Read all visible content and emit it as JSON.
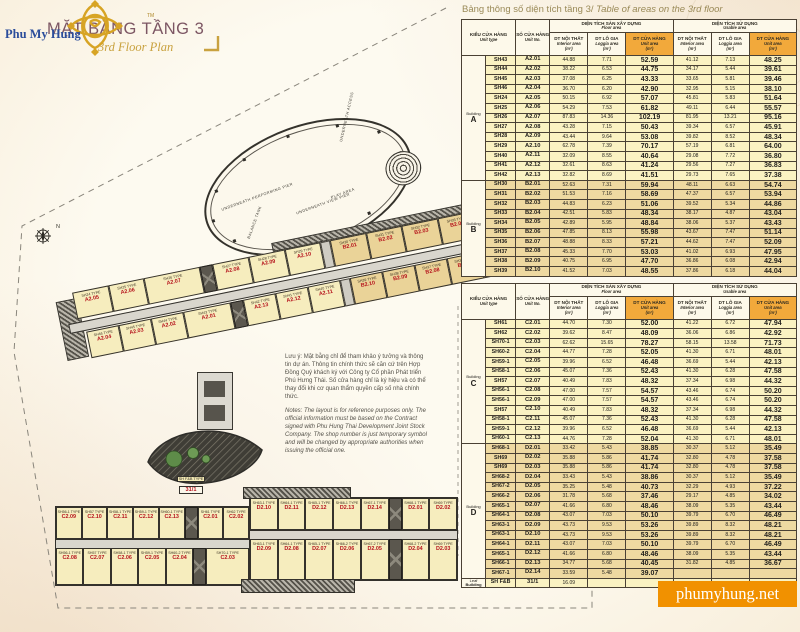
{
  "header": {
    "brand": "Phu My Hung",
    "brand_tm": "TM",
    "title_vi": "MẶT BẰNG TẦNG 3",
    "title_en": "3rd Floor Plan"
  },
  "plan": {
    "compass_label": "N",
    "ellipse_labels": {
      "performing": "UNDERNEATH PERFORMING PIER",
      "access": "UNDERNEATH ACCESS",
      "view_pier": "UNDERNEATH VIEW PIER",
      "play_area": "PLAY AREA",
      "balance_tank": "BALANCE TANK"
    },
    "notes_vi": "Lưu ý: Mặt bằng chỉ để tham khảo ý tưởng và thông tin dự án. Thông tin chính thức sẽ căn cứ trên Hợp Đồng Quý khách ký với Công ty Cổ phần Phát triển Phú Hưng Thái. Số cửa hàng chỉ là ký hiệu và có thể thay đổi khi cơ quan thẩm quyền cấp số nhà chính thức.",
    "notes_en": "Notes: The layout is for reference purposes only. The official information must be based on the Contract signed with Phu Hung Thai Development Joint Stock Company. The shop number is just temporary symbol and will be changed by appropriate authorities when issuing the official one.",
    "leaf": {
      "type": "SH F&B TYPE",
      "no": "31/1"
    },
    "strips": {
      "a_top": [
        {
          "t": "SH24 TYPE",
          "n": "A2.05"
        },
        {
          "t": "SH25 TYPE",
          "n": "A2.06"
        },
        {
          "t": "SH26 TYPE",
          "n": "A2.07",
          "w": 1.6
        },
        {
          "core": true
        },
        {
          "t": "SH27 TYPE",
          "n": "A2.08"
        },
        {
          "t": "SH28 TYPE",
          "n": "A2.09"
        },
        {
          "t": "SH29 TYPE",
          "n": "A2.10"
        },
        {
          "gap": true
        },
        {
          "t": "SH30 TYPE",
          "n": "B2.01",
          "b": 1
        },
        {
          "t": "SH31 TYPE",
          "n": "B2.02",
          "b": 1
        },
        {
          "t": "SH32 TYPE",
          "n": "B2.03",
          "b": 1
        },
        {
          "t": "SH33 TYPE",
          "n": "B2.04",
          "b": 1
        },
        {
          "t": "SH34 TYPE",
          "n": "B2.05",
          "b": 1
        }
      ],
      "a_bottom": [
        {
          "t": "SH46 TYPE",
          "n": "A2.04"
        },
        {
          "t": "SH45 TYPE",
          "n": "A2.03"
        },
        {
          "t": "SH44 TYPE",
          "n": "A2.02"
        },
        {
          "t": "SH43 TYPE",
          "n": "A2.01",
          "w": 1.5
        },
        {
          "core": true
        },
        {
          "t": "SH42 TYPE",
          "n": "A2.13"
        },
        {
          "t": "SH41 TYPE",
          "n": "A2.12"
        },
        {
          "t": "SH40 TYPE",
          "n": "A2.11"
        },
        {
          "gap": true
        },
        {
          "t": "SH39 TYPE",
          "n": "B2.10",
          "b": 1
        },
        {
          "t": "SH38 TYPE",
          "n": "B2.09",
          "b": 1
        },
        {
          "t": "SH37 TYPE",
          "n": "B2.08",
          "b": 1
        },
        {
          "t": "SH36 TYPE",
          "n": "B2.07",
          "b": 1
        },
        {
          "t": "SH35 TYPE",
          "n": "B2.06",
          "b": 1
        }
      ],
      "c_top": [
        {
          "t": "SH56-1 TYPE",
          "n": "C2.09"
        },
        {
          "t": "SH57 TYPE",
          "n": "C2.10"
        },
        {
          "t": "SH58-1 TYPE",
          "n": "C2.11"
        },
        {
          "t": "SH59-1 TYPE",
          "n": "C2.12"
        },
        {
          "t": "SH60-1 TYPE",
          "n": "C2.13"
        },
        {
          "core": true
        },
        {
          "t": "SH61 TYPE",
          "n": "C2.01"
        },
        {
          "t": "SH62 TYPE",
          "n": "C2.02"
        }
      ],
      "c_bottom": [
        {
          "t": "SH56-1 TYPE",
          "n": "C2.08"
        },
        {
          "t": "SH57 TYPE",
          "n": "C2.07"
        },
        {
          "t": "SH58-1 TYPE",
          "n": "C2.06"
        },
        {
          "t": "SH59-1 TYPE",
          "n": "C2.05"
        },
        {
          "t": "SH60-2 TYPE",
          "n": "C2.04"
        },
        {
          "core": true
        },
        {
          "t": "SH70-1 TYPE",
          "n": "C2.03",
          "w": 1.6
        }
      ],
      "d_top": [
        {
          "t": "SH63-1 TYPE",
          "n": "D2.10"
        },
        {
          "t": "SH64-1 TYPE",
          "n": "D2.11"
        },
        {
          "t": "SH65-1 TYPE",
          "n": "D2.12"
        },
        {
          "t": "SH66-1 TYPE",
          "n": "D2.13"
        },
        {
          "t": "SH67-1 TYPE",
          "n": "D2.14"
        },
        {
          "core": true
        },
        {
          "t": "SH68-1 TYPE",
          "n": "D2.01"
        },
        {
          "t": "SH69 TYPE",
          "n": "D2.02"
        }
      ],
      "d_bottom": [
        {
          "t": "SH63-1 TYPE",
          "n": "D2.09"
        },
        {
          "t": "SH64-1 TYPE",
          "n": "D2.08"
        },
        {
          "t": "SH65-1 TYPE",
          "n": "D2.07"
        },
        {
          "t": "SH66-2 TYPE",
          "n": "D2.06"
        },
        {
          "t": "SH67-2 TYPE",
          "n": "D2.05"
        },
        {
          "core": true
        },
        {
          "t": "SH68-2 TYPE",
          "n": "D2.04"
        },
        {
          "t": "SH69 TYPE",
          "n": "D2.03"
        }
      ]
    }
  },
  "table_title": {
    "vi": "Bảng thông số diện tích tầng 3/",
    "en": " Table of areas on the 3rd floor"
  },
  "table_header": {
    "unit_type_vi": "KIỂU CỬA HÀNG",
    "unit_type_en": "Unit type",
    "unit_no_vi": "SỐ CỬA HÀNG",
    "unit_no_en": "Unit No.",
    "floor_area_vi": "DIỆN TÍCH SÀN XÂY DỰNG",
    "floor_area_en": "Floor area",
    "usable_area_vi": "DIỆN TÍCH SỬ DỤNG",
    "usable_area_en": "Usable area",
    "interior_vi": "DT NỘI THẤT",
    "interior_en": "Interior area",
    "loggia_vi": "DT LÔ GIA",
    "loggia_en": "Loggia area",
    "unit_vi": "DT CỬA HÀNG",
    "unit_en": "Unit area",
    "sqm": "(m²)"
  },
  "tables": [
    {
      "groups": [
        {
          "label_top": "Building",
          "label_main": "A",
          "shade": "light",
          "rows": [
            [
              "SH43",
              "A2.01",
              "44.88",
              "7.71",
              "52.59",
              "41.12",
              "7.13",
              "48.25"
            ],
            [
              "SH44",
              "A2.02",
              "38.22",
              "6.53",
              "44.75",
              "34.17",
              "5.44",
              "39.61"
            ],
            [
              "SH45",
              "A2.03",
              "37.08",
              "6.25",
              "43.33",
              "33.65",
              "5.81",
              "39.46"
            ],
            [
              "SH46",
              "A2.04",
              "36.70",
              "6.20",
              "42.90",
              "32.95",
              "5.15",
              "38.10"
            ],
            [
              "SH24",
              "A2.05",
              "50.15",
              "6.92",
              "57.07",
              "45.81",
              "5.83",
              "51.64"
            ],
            [
              "SH25",
              "A2.06",
              "54.29",
              "7.53",
              "61.82",
              "49.11",
              "6.44",
              "55.57"
            ],
            [
              "SH26",
              "A2.07",
              "87.83",
              "14.36",
              "102.19",
              "81.95",
              "13.21",
              "95.16"
            ],
            [
              "SH27",
              "A2.08",
              "43.28",
              "7.15",
              "50.43",
              "39.34",
              "6.57",
              "45.91"
            ],
            [
              "SH28",
              "A2.09",
              "43.44",
              "9.64",
              "53.08",
              "39.82",
              "8.52",
              "48.34"
            ],
            [
              "SH29",
              "A2.10",
              "62.78",
              "7.39",
              "70.17",
              "57.19",
              "6.81",
              "64.00"
            ],
            [
              "SH40",
              "A2.11",
              "32.09",
              "8.55",
              "40.64",
              "29.08",
              "7.72",
              "36.80"
            ],
            [
              "SH41",
              "A2.12",
              "32.61",
              "8.63",
              "41.24",
              "29.56",
              "7.27",
              "36.83"
            ],
            [
              "SH42",
              "A2.13",
              "32.82",
              "8.69",
              "41.51",
              "29.73",
              "7.65",
              "37.38"
            ]
          ]
        },
        {
          "label_top": "Building",
          "label_main": "B",
          "shade": "dark",
          "rows": [
            [
              "SH30",
              "B2.01",
              "52.63",
              "7.31",
              "59.94",
              "48.11",
              "6.63",
              "54.74"
            ],
            [
              "SH31",
              "B2.02",
              "51.53",
              "7.16",
              "58.69",
              "47.37",
              "6.57",
              "53.94"
            ],
            [
              "SH32",
              "B2.03",
              "44.83",
              "6.23",
              "51.06",
              "39.52",
              "5.34",
              "44.86"
            ],
            [
              "SH33",
              "B2.04",
              "42.51",
              "5.83",
              "48.34",
              "38.17",
              "4.87",
              "43.04"
            ],
            [
              "SH34",
              "B2.05",
              "42.89",
              "5.95",
              "48.84",
              "38.06",
              "5.37",
              "43.43"
            ],
            [
              "SH35",
              "B2.06",
              "47.85",
              "8.13",
              "55.98",
              "43.67",
              "7.47",
              "51.14"
            ],
            [
              "SH36",
              "B2.07",
              "48.88",
              "8.33",
              "57.21",
              "44.62",
              "7.47",
              "52.09"
            ],
            [
              "SH37",
              "B2.08",
              "45.33",
              "7.70",
              "53.03",
              "41.02",
              "6.93",
              "47.95"
            ],
            [
              "SH38",
              "B2.09",
              "40.75",
              "6.95",
              "47.70",
              "36.86",
              "6.08",
              "42.94"
            ],
            [
              "SH39",
              "B2.10",
              "41.52",
              "7.03",
              "48.55",
              "37.86",
              "6.18",
              "44.04"
            ]
          ]
        }
      ]
    },
    {
      "groups": [
        {
          "label_top": "Building",
          "label_main": "C",
          "shade": "light",
          "rows": [
            [
              "SH61",
              "C2.01",
              "44.70",
              "7.30",
              "52.00",
              "41.22",
              "6.72",
              "47.94"
            ],
            [
              "SH62",
              "C2.02",
              "39.62",
              "8.47",
              "48.09",
              "36.06",
              "6.86",
              "42.92"
            ],
            [
              "SH70-1",
              "C2.03",
              "62.62",
              "15.65",
              "78.27",
              "58.15",
              "13.58",
              "71.73"
            ],
            [
              "SH60-2",
              "C2.04",
              "44.77",
              "7.28",
              "52.05",
              "41.30",
              "6.71",
              "48.01"
            ],
            [
              "SH59-1",
              "C2.05",
              "39.96",
              "6.52",
              "46.48",
              "36.69",
              "5.44",
              "42.13"
            ],
            [
              "SH58-1",
              "C2.06",
              "45.07",
              "7.36",
              "52.43",
              "41.30",
              "6.28",
              "47.58"
            ],
            [
              "SH57",
              "C2.07",
              "40.49",
              "7.83",
              "48.32",
              "37.34",
              "6.98",
              "44.32"
            ],
            [
              "SH56-1",
              "C2.08",
              "47.00",
              "7.57",
              "54.57",
              "43.46",
              "6.74",
              "50.20"
            ],
            [
              "SH56-1",
              "C2.09",
              "47.00",
              "7.57",
              "54.57",
              "43.46",
              "6.74",
              "50.20"
            ],
            [
              "SH57",
              "C2.10",
              "40.49",
              "7.83",
              "48.32",
              "37.34",
              "6.98",
              "44.32"
            ],
            [
              "SH58-1",
              "C2.11",
              "45.07",
              "7.36",
              "52.43",
              "41.30",
              "6.28",
              "47.58"
            ],
            [
              "SH59-1",
              "C2.12",
              "39.96",
              "6.52",
              "46.48",
              "36.69",
              "5.44",
              "42.13"
            ],
            [
              "SH60-1",
              "C2.13",
              "44.76",
              "7.28",
              "52.04",
              "41.30",
              "6.71",
              "48.01"
            ]
          ]
        },
        {
          "label_top": "Building",
          "label_main": "D",
          "shade": "dark",
          "rows": [
            [
              "SH68-1",
              "D2.01",
              "33.42",
              "5.43",
              "38.85",
              "30.37",
              "5.12",
              "35.49"
            ],
            [
              "SH69",
              "D2.02",
              "35.88",
              "5.86",
              "41.74",
              "32.80",
              "4.78",
              "37.58"
            ],
            [
              "SH69",
              "D2.03",
              "35.88",
              "5.86",
              "41.74",
              "32.80",
              "4.78",
              "37.58"
            ],
            [
              "SH68-2",
              "D2.04",
              "33.43",
              "5.43",
              "38.86",
              "30.37",
              "5.12",
              "35.49"
            ],
            [
              "SH67-2",
              "D2.05",
              "35.25",
              "5.48",
              "40.73",
              "32.29",
              "4.93",
              "37.22"
            ],
            [
              "SH66-2",
              "D2.06",
              "31.78",
              "5.68",
              "37.46",
              "29.17",
              "4.85",
              "34.02"
            ],
            [
              "SH65-1",
              "D2.07",
              "41.66",
              "6.80",
              "48.46",
              "38.09",
              "5.35",
              "43.44"
            ],
            [
              "SH64-1",
              "D2.08",
              "43.07",
              "7.03",
              "50.10",
              "39.79",
              "6.70",
              "46.49"
            ],
            [
              "SH63-1",
              "D2.09",
              "43.73",
              "9.53",
              "53.26",
              "39.89",
              "8.32",
              "48.21"
            ],
            [
              "SH63-1",
              "D2.10",
              "43.73",
              "9.53",
              "53.26",
              "39.89",
              "8.32",
              "48.21"
            ],
            [
              "SH64-1",
              "D2.11",
              "43.07",
              "7.03",
              "50.10",
              "39.79",
              "6.70",
              "46.49"
            ],
            [
              "SH65-1",
              "D2.12",
              "41.66",
              "6.80",
              "48.46",
              "38.09",
              "5.35",
              "43.44"
            ],
            [
              "SH66-1",
              "D2.13",
              "34.77",
              "5.68",
              "40.45",
              "31.82",
              "4.85",
              "36.67"
            ],
            [
              "SH67-1",
              "D2.14",
              "33.59",
              "5.48",
              "39.07",
              "",
              "",
              ""
            ]
          ]
        },
        {
          "label_top": "Leaf",
          "label_main": "Building",
          "shade": "light",
          "small": true,
          "rows": [
            [
              "SH F&B",
              "31/1",
              "16.09",
              "",
              "",
              "",
              "",
              ""
            ]
          ]
        }
      ]
    }
  ],
  "watermark": "phumyhung.net",
  "colors": {
    "accent_orange": "#f19100",
    "header_orange": "#f2a93b",
    "row_yellow": "#faf2c2",
    "row_tan": "#eed9a1",
    "unit_number_red": "#b5121b",
    "title_plum": "#7c5663",
    "gold": "#c9a23f",
    "brand_blue": "#2b4d9b"
  }
}
